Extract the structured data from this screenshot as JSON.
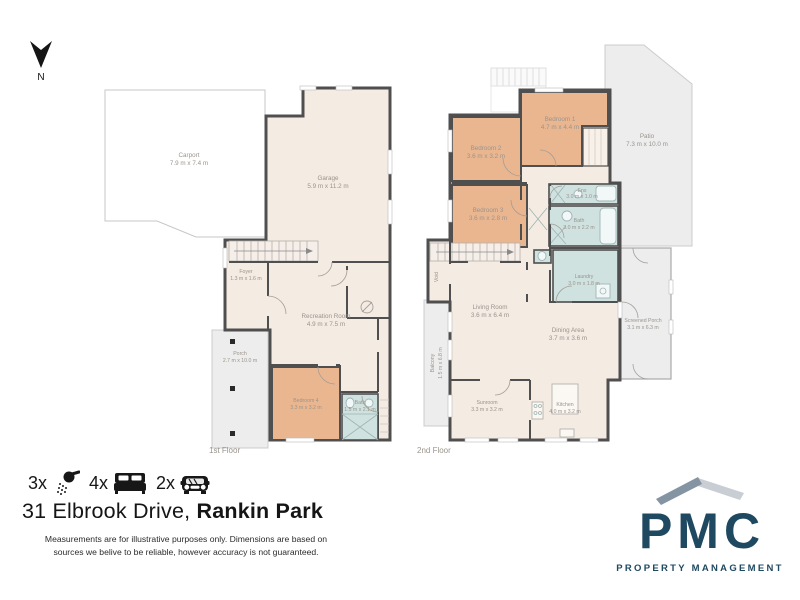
{
  "colors": {
    "interior": "#f4ebe3",
    "bedroom": "#eab690",
    "wet": "#cfe2e0",
    "outdoor": "#ededed",
    "wall": "#4f4f4f",
    "label": "#9a948c",
    "logo_navy": "#1e4961",
    "roof_left": "#8494a2",
    "roof_right": "#c9ced4"
  },
  "north_label": "N",
  "floors": [
    {
      "label": "1st Floor",
      "rooms": [
        {
          "name": "Carport",
          "dims": "7.9 m x 7.4 m"
        },
        {
          "name": "Garage",
          "dims": "5.9 m x 11.2 m"
        },
        {
          "name": "Foyer",
          "dims": "1.3 m x 1.6 m"
        },
        {
          "name": "Recreation Room",
          "dims": "4.9 m x 7.5 m"
        },
        {
          "name": "Porch",
          "dims": "2.7 m x 10.0 m"
        },
        {
          "name": "Bedroom 4",
          "dims": "3.3 m x 3.2 m"
        },
        {
          "name": "Bath",
          "dims": "1.5 m x 2.1 m"
        }
      ]
    },
    {
      "label": "2nd Floor",
      "rooms": [
        {
          "name": "Bedroom 1",
          "dims": "4.7 m x 4.4 m"
        },
        {
          "name": "Bedroom 2",
          "dims": "3.6 m x 3.2 m"
        },
        {
          "name": "Bedroom 3",
          "dims": "3.6 m x 2.8 m"
        },
        {
          "name": "Ens",
          "dims": "3.0 m x 1.0 m"
        },
        {
          "name": "Bath",
          "dims": "3.0 m x 2.2 m"
        },
        {
          "name": "Laundry",
          "dims": "3.0 m x 1.8 m"
        },
        {
          "name": "Void",
          "dims": ""
        },
        {
          "name": "Living Room",
          "dims": "3.6 m x 6.4 m"
        },
        {
          "name": "Dining Area",
          "dims": "3.7 m x 3.6 m"
        },
        {
          "name": "Balcony",
          "dims": "1.5 m x 6.8 m"
        },
        {
          "name": "Sunroom",
          "dims": "3.3 m x 3.2 m"
        },
        {
          "name": "Kitchen",
          "dims": "4.0 m x 3.2 m"
        },
        {
          "name": "Screened Porch",
          "dims": "3.1 m x 6.3 m"
        },
        {
          "name": "Patio",
          "dims": "7.3 m x 10.0 m"
        }
      ]
    }
  ],
  "footer": {
    "features": [
      {
        "count": "3x",
        "icon": "shower-icon"
      },
      {
        "count": "4x",
        "icon": "bed-icon"
      },
      {
        "count": "2x",
        "icon": "car-icon"
      }
    ],
    "address_regular": "31 Elbrook Drive,",
    "address_bold": "Rankin Park",
    "disclaimer_line1": "Measurements are for illustrative purposes only. Dimensions are based on",
    "disclaimer_line2": "sources we belive to be reliable, however accuracy is not guaranteed."
  },
  "logo": {
    "name": "PMC",
    "tagline": "PROPERTY MANAGEMENT"
  }
}
